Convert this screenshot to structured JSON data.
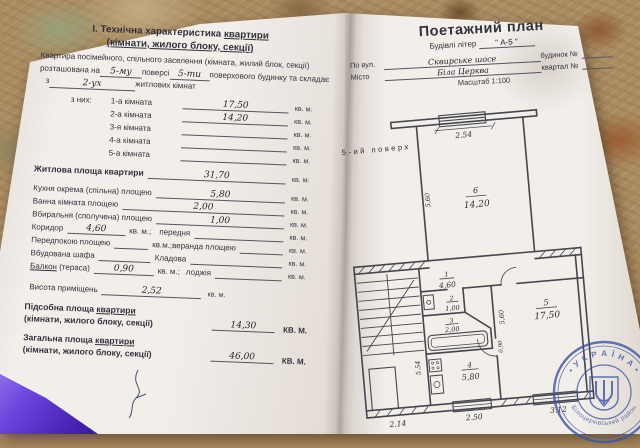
{
  "left_page": {
    "title_line1_pre": "І. Технічна характеристика ",
    "title_line1_u": "квартири",
    "title_line2": "(кімнати, жилого блоку, секції)",
    "intro_line1": "Квартира посімейного, спільного заселення (кімната, жилий блок, секції)",
    "intro2_pre": "розташована на",
    "intro2_val1": "5-му",
    "intro2_mid": "поверсі",
    "intro2_val2": "5-ти",
    "intro2_post": "поверхового будинку та складає",
    "intro3_pre": "з",
    "intro3_val": "2-ух",
    "intro3_post": "житлових кімнат",
    "iz_nih": "з них:",
    "unit": "кв. м.",
    "unit_semi": "кв. м.;",
    "unit_semi2": "кв.м.;",
    "unit_caps": "КВ. М.",
    "rooms": [
      {
        "label": "1-а кімната",
        "value": "17,50"
      },
      {
        "label": "2-а кімната",
        "value": "14,20"
      },
      {
        "label": "3-я кімната",
        "value": ""
      },
      {
        "label": "4-а кімната",
        "value": ""
      },
      {
        "label": "5-а кімната",
        "value": ""
      }
    ],
    "living": {
      "label": "Житлова площа квартири",
      "value": "31,70"
    },
    "kitchen": {
      "label": "Кухня окрема (спільна) площею",
      "value": "5,80"
    },
    "bath": {
      "label": "Ванна кімната площею",
      "value": "2,00"
    },
    "wc": {
      "label": "Вбиральня (сполучена) площею",
      "value": "1,00"
    },
    "corridor": {
      "label": "Коридор",
      "value": "4,60",
      "label2": "передня"
    },
    "perednia": {
      "label": "Передпокою площею",
      "label2": "веранда площею"
    },
    "shafa": {
      "label": "Вбудована шафа",
      "label2": "Кладова"
    },
    "balkon": {
      "label_u": "Балкон",
      "label_rest": " (тераса)",
      "value": "0,90",
      "label2": "лоджія"
    },
    "height": {
      "label": "Висота приміщень",
      "value": "2,52"
    },
    "podsobna": {
      "label1_pre": "Підсобна площа ",
      "label1_u": "квартири",
      "label2": "(кімнати, жилого блоку, секції)",
      "value": "14,30"
    },
    "zagalna": {
      "label1_pre": "Загальна площа ",
      "label1_u": "квартири",
      "label2": "(кімнати, жилого блоку, секції)",
      "value": "46,00"
    }
  },
  "right_page": {
    "title": "Поетажний план",
    "subtitle_pre": "Будівлі літер",
    "subtitle_val": "\" А-5 \"",
    "street_label": "По вул.",
    "street_value": "Сквирське шосе",
    "house_label": "будинок №",
    "city_label": "Місто",
    "city_value": "Біла Церква",
    "kvartal_label": "квартал №",
    "scale": "Масштаб 1:100",
    "floor_label": "5-ий поверх"
  },
  "plan": {
    "room6_num": "6",
    "room6_area": "14,20",
    "room1_num": "1",
    "room1_area": "4,60",
    "room2_num": "2",
    "room2_area": "1,00",
    "room3_num": "3",
    "room3_area": "2,00",
    "room4_num": "4",
    "room4_area": "5,80",
    "room5_num": "5",
    "room5_area": "17,50",
    "dim_top": "2.54",
    "dim_room6_side": "5,60",
    "dim_stair_bottom": "2.14",
    "dim_kitchen_bottom": "2.50",
    "dim_room5_bottom": "3.12",
    "dim_left_side": "5.54",
    "dim_door": "0,90",
    "dim_room5_side": "5,60"
  },
  "stamp": {
    "top_text": "• У К Р А Ї Н А •",
    "bottom_text": "Білоцерківський район"
  }
}
